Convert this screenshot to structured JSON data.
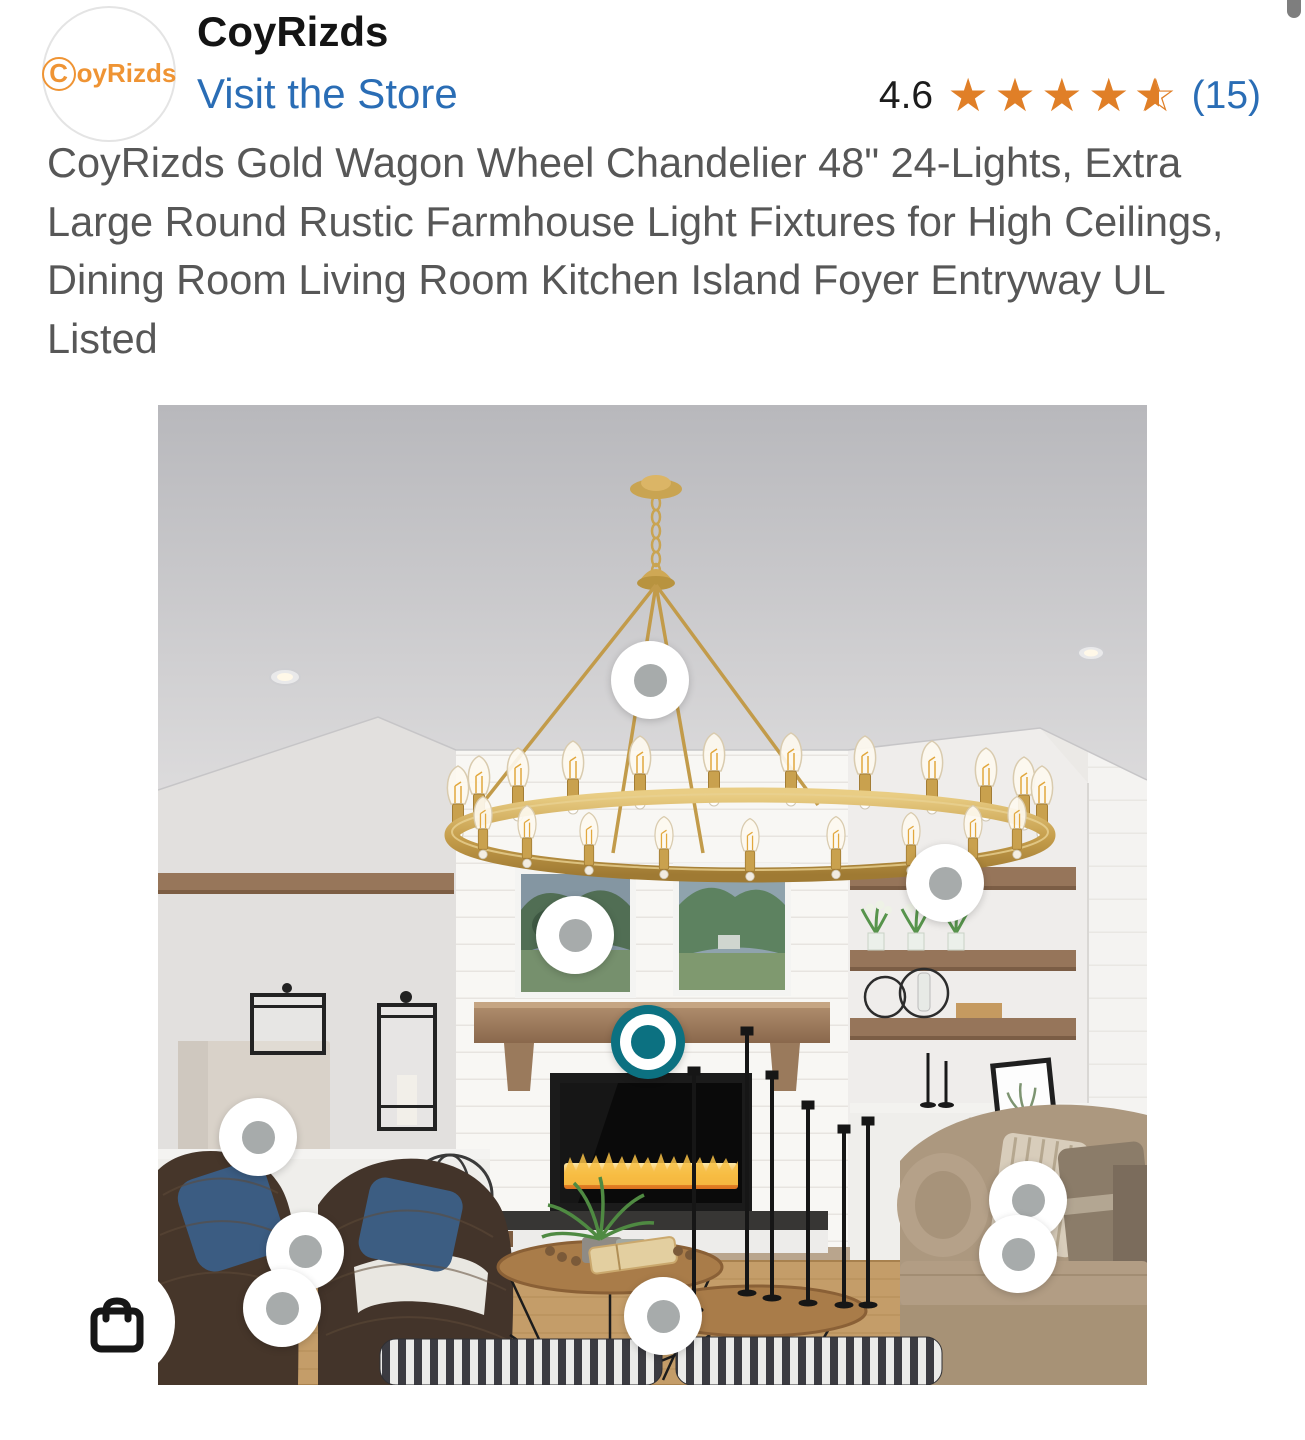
{
  "header": {
    "logo_text": "CoyRizds",
    "brand_name": "CoyRizds",
    "visit_store_label": "Visit the Store",
    "rating": {
      "score": "4.6",
      "stars_value": 4.6,
      "stars_full": 4,
      "stars_half": true,
      "count_label": "(15)"
    }
  },
  "product": {
    "title": "CoyRizds Gold Wagon Wheel Chandelier 48\" 24-Lights, Extra Large Round Rustic Farmhouse Light Fixtures for High Ceilings, Dining Room Living Room Kitchen Island Foyer Entryway UL Listed"
  },
  "photo": {
    "description": "Living room scene: gold wagon wheel chandelier with Edison bulbs hanging from gray ceiling over farmhouse room with white shiplap fireplace, two green landscape paintings, wood mantel, built-in white cabinets, floating wood shelves, wicker chairs with blue pillows, tan couch, round wood coffee tables, striped ottomans and jute rug",
    "markers": [
      {
        "x": 492,
        "y": 275,
        "selected": false
      },
      {
        "x": 787,
        "y": 478,
        "selected": false
      },
      {
        "x": 417,
        "y": 530,
        "selected": false
      },
      {
        "x": 490,
        "y": 637,
        "selected": true
      },
      {
        "x": 100,
        "y": 732,
        "selected": false
      },
      {
        "x": 147,
        "y": 846,
        "selected": false
      },
      {
        "x": 124,
        "y": 903,
        "selected": false
      },
      {
        "x": 870,
        "y": 795,
        "selected": false
      },
      {
        "x": 860,
        "y": 849,
        "selected": false
      },
      {
        "x": 505,
        "y": 911,
        "selected": false
      }
    ],
    "bag_icon": "shopping-bag-icon"
  },
  "colors": {
    "star_orange": "#e07f27",
    "link_blue": "#2a6db5",
    "logo_orange": "#ef9434",
    "marker_teal": "#0c7181",
    "marker_dot_gray": "#a7abab",
    "title_gray": "#575757",
    "chandelier_gold": "#c9a14e"
  }
}
